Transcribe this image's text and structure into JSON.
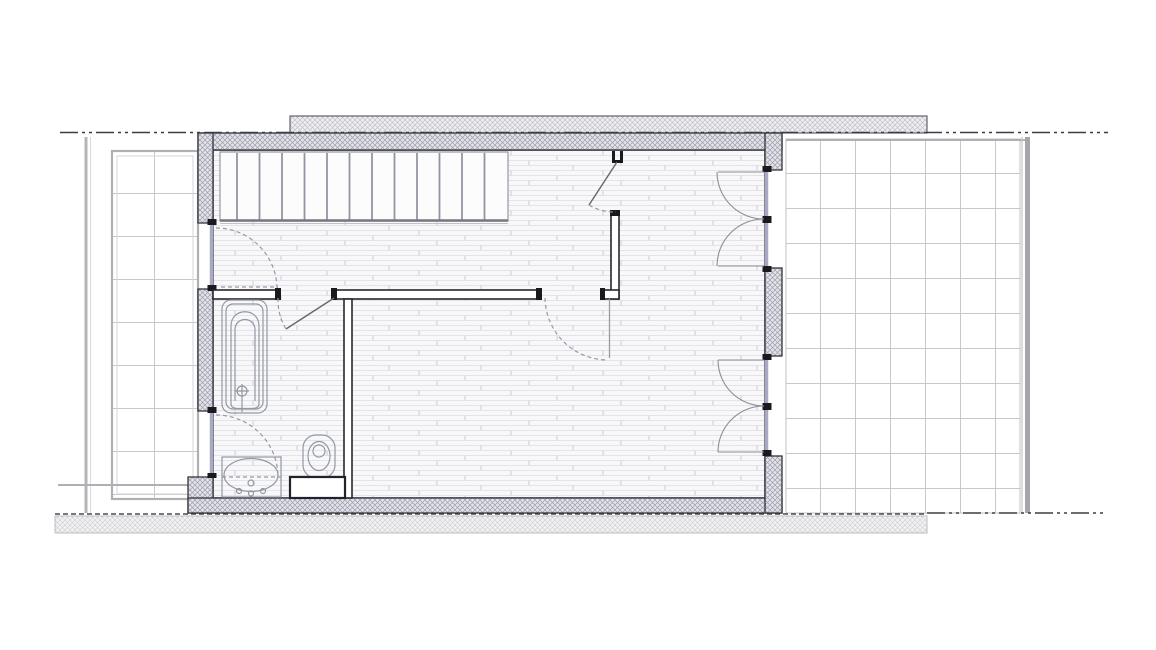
{
  "document": {
    "kind": "architectural floor plan (plan view, no text labels visible)",
    "orientation": "landscape"
  },
  "colors": {
    "background": "#ffffff",
    "wall_outline": "#33333a",
    "interior_wall_outline": "#26262c",
    "cap_black": "#1a1a1e",
    "fixture_line": "#9298a2",
    "swing_dash": "#9898ac",
    "glazing": "#a9a9c6",
    "tread_line": "#9393a3",
    "terrace_frame": "#b0b0b4",
    "boundary_line": "#3c3c44",
    "floor_line": "#e3e3e8",
    "door_leaf": "#66666e"
  },
  "plan": {
    "boundary": "dash-dot property lines along top and bottom",
    "terraces": [
      {
        "side": "left",
        "finish": "square tiles"
      },
      {
        "side": "right",
        "finish": "square tiles"
      }
    ],
    "rooms": [
      {
        "name": "stair-hall",
        "floor": "wood planks",
        "features": [
          "straight staircase of 13 treads along top wall",
          "inswing window on left wall"
        ]
      },
      {
        "name": "living-room",
        "floor": "wood planks",
        "features": [
          "two double french doors to right terrace",
          "door from stair-hall"
        ]
      },
      {
        "name": "bathroom",
        "floor": "wood planks",
        "features": [
          "bathtub",
          "washbasin",
          "wall-hung toilet",
          "concealed cistern box",
          "inswing window on left wall"
        ]
      }
    ],
    "doors": [
      {
        "name": "stairhall-door",
        "type": "hinged, partially open, at top partition"
      },
      {
        "name": "bathroom-door",
        "type": "hinged, partially open"
      },
      {
        "name": "livingroom-door",
        "type": "hinged, open 90°, dashed swing"
      },
      {
        "name": "french-door-upper",
        "type": "double leaf, quarter-circle swings"
      },
      {
        "name": "french-door-lower",
        "type": "double leaf, quarter-circle swings"
      }
    ],
    "windows": [
      {
        "name": "window-stairhall",
        "swing": "dashed quarter arc"
      },
      {
        "name": "window-bathroom",
        "swing": "dashed quarter arc"
      }
    ]
  }
}
